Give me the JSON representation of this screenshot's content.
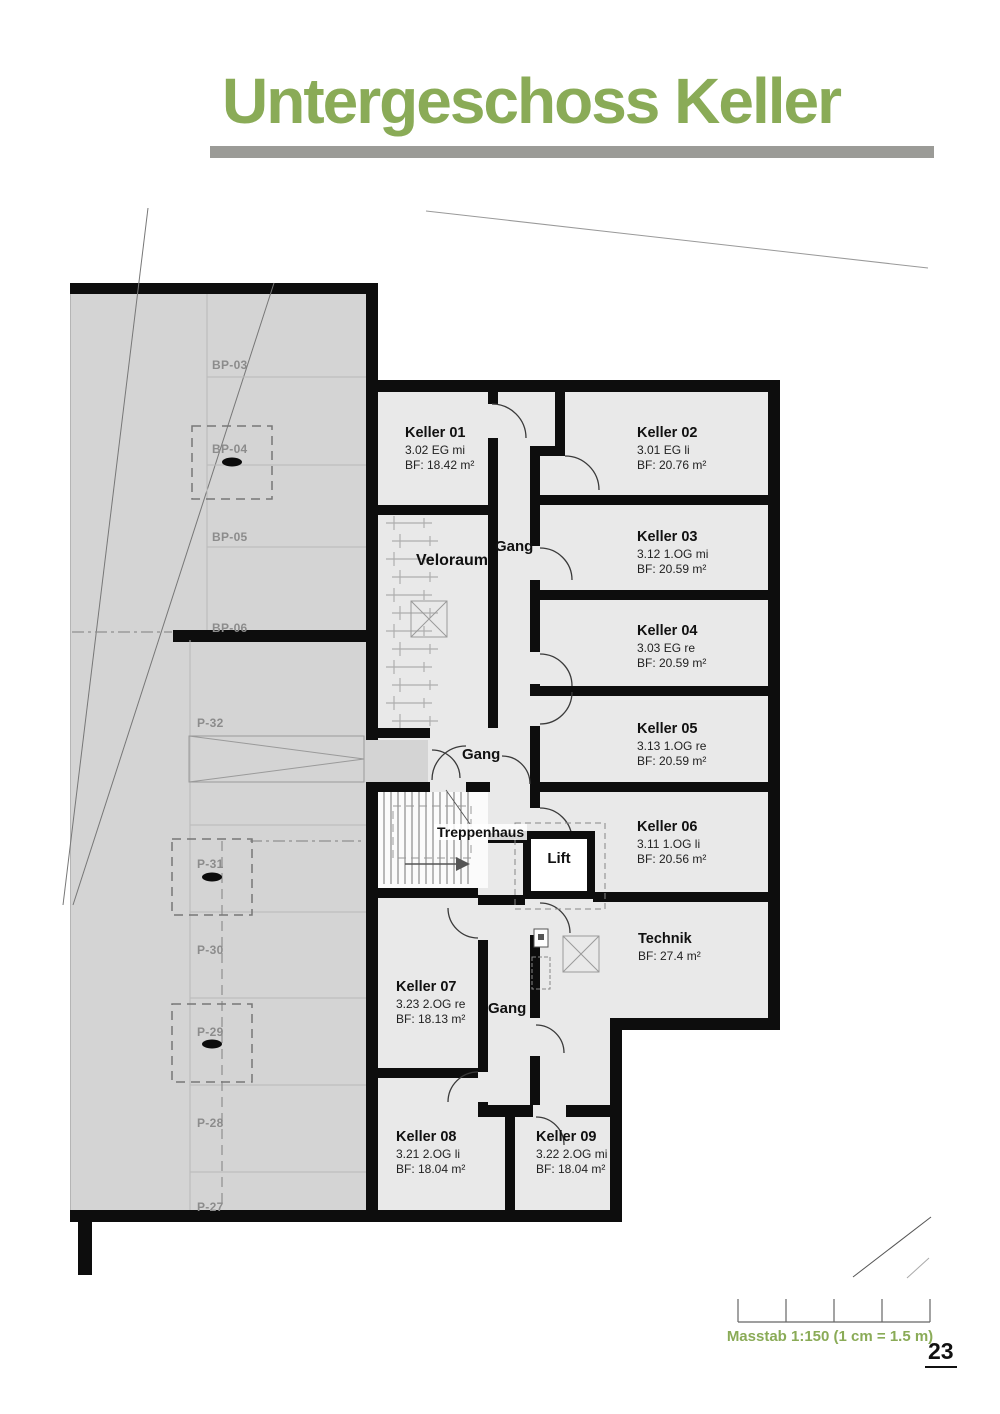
{
  "header": {
    "title": "Untergeschoss Keller"
  },
  "plan": {
    "rooms": [
      {
        "name": "Keller 01",
        "code": "3.02 EG mi",
        "area": "BF: 18.42 m²"
      },
      {
        "name": "Keller 02",
        "code": "3.01 EG li",
        "area": "BF: 20.76 m²"
      },
      {
        "name": "Keller 03",
        "code": "3.12 1.OG mi",
        "area": "BF: 20.59 m²"
      },
      {
        "name": "Keller 04",
        "code": "3.03 EG re",
        "area": "BF: 20.59 m²"
      },
      {
        "name": "Keller 05",
        "code": "3.13 1.OG re",
        "area": "BF: 20.59 m²"
      },
      {
        "name": "Keller 06",
        "code": "3.11 1.OG li",
        "area": "BF: 20.56 m²"
      },
      {
        "name": "Keller 07",
        "code": "3.23 2.OG re",
        "area": "BF: 18.13 m²"
      },
      {
        "name": "Keller 08",
        "code": "3.21 2.OG li",
        "area": "BF: 18.04 m²"
      },
      {
        "name": "Keller 09",
        "code": "3.22 2.OG mi",
        "area": "BF: 18.04 m²"
      }
    ],
    "spaces": {
      "veloraum": "Veloraum",
      "gang_upper": "Gang",
      "gang_mid": "Gang",
      "gang_lower": "Gang",
      "treppenhaus": "Treppenhaus",
      "lift": "Lift",
      "technik_name": "Technik",
      "technik_area": "BF: 27.4 m²"
    },
    "parking_stalls": [
      "BP-03",
      "BP-04",
      "BP-05",
      "BP-06",
      "P-32",
      "P-31",
      "P-30",
      "P-29",
      "P-28",
      "P-27"
    ]
  },
  "footer": {
    "scale_label": "Masstab 1:150 (1 cm = 1.5 m)",
    "page_number": "23"
  },
  "colors": {
    "accent_green": "#8aab57",
    "underline_gray": "#9b9b97",
    "parking_fill": "#d4d4d4",
    "room_fill": "#e9e9e9",
    "wall": "#0d0d0d"
  }
}
